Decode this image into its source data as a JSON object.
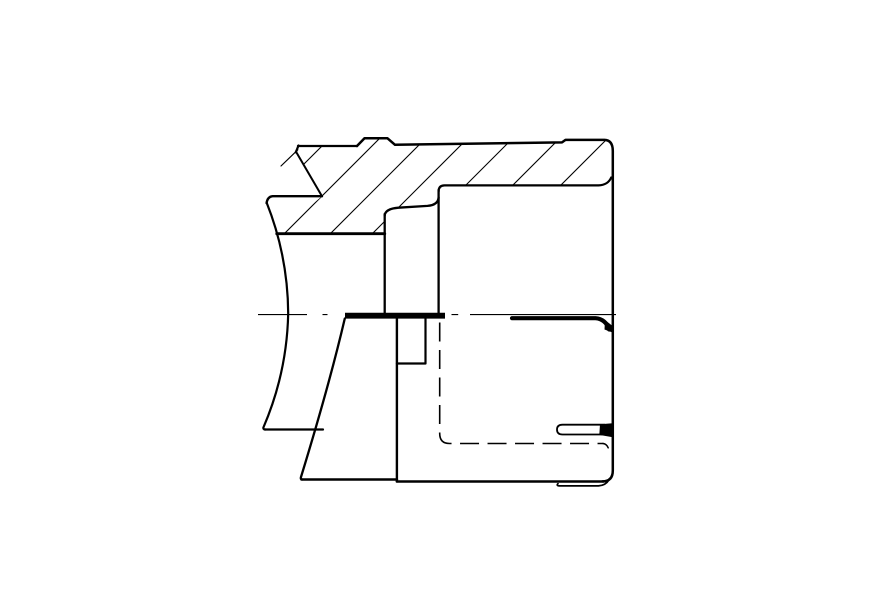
{
  "drawing": {
    "description": "engineering-section-view",
    "background": "#ffffff",
    "ink": "#000000",
    "viewport": {
      "width": 891,
      "height": 603
    },
    "hatch": {
      "clip_d": "M298,146 L357,146 L364.5,138.3 L387.5,138.3 L395,144.8 L562,142.4 L565.5,139.9 L609,140 L612.8,152 L612.8,184.8 L444,184.8 L438.6,191.5 L438.6,197.5 L427.5,205.9 L398.5,207.7 L384.7,215.5 L384.7,233.7 L276.8,233.7 L322,196.2 L295.9,151.5 Z",
      "c_values": [
        468,
        518,
        564,
        606,
        651,
        698,
        746
      ],
      "y_min": 128,
      "y_max": 242,
      "w": 1.1
    },
    "strokes": [
      {
        "name": "outline-top-left-edge",
        "d": "M298,146 H357",
        "w": 2.3
      },
      {
        "name": "outline-bump-and-right-wall",
        "d": "M357,146 L364.5,138.3 H387.5 L395,144.8 L562,142.4 L565.5,139.9 H604.5 Q612.8,140.2 612.8,151 V470.5 Q612.8,481.4 602.5,481.4",
        "w": 2.5
      },
      {
        "name": "cavity-top-edge",
        "d": "M438.6,191.5 Q438.6,185.4 444.5,185.4 H598.5 Q608,185 611.2,177.5",
        "w": 2.2
      },
      {
        "name": "inner-wall-vertical",
        "d": "M438.6,190 V313.2",
        "w": 2.3
      },
      {
        "name": "step-profile",
        "d": "M438.6,197.5 Q438,205 427.5,205.9 L398.5,207.7 Q385.2,208.8 384.7,215.5",
        "w": 2.3
      },
      {
        "name": "hatch-left-wall",
        "d": "M384.7,214 V313.2",
        "w": 2.3
      },
      {
        "name": "hatch-bottom-edge",
        "d": "M276.8,233.7 H384.7",
        "w": 2.9
      },
      {
        "name": "break-tick",
        "d": "M298.5,145.5 L295.8,152.3",
        "w": 2.2
      },
      {
        "name": "break-line-steep",
        "d": "M295.9,151.5 L322,196.2",
        "w": 2.0
      },
      {
        "name": "break-jag-thin",
        "d": "M297.8,149.8 L281,166",
        "w": 1.2
      },
      {
        "name": "left-part-top-edge",
        "d": "M322,196.2 H272.6 Q267.6,196.6 266.6,203",
        "w": 2.4
      },
      {
        "name": "left-spherical-arc",
        "d": "M266.6,202.5 A305,305 0 0 1 288.2,313.5 A305,305 0 0 1 263.4,427.5 Q263,429.5 265.5,429.5",
        "w": 2.2
      },
      {
        "name": "left-part-bottom-edge",
        "d": "M264.5,429.5 H323",
        "w": 2.2
      },
      {
        "name": "sleeve-arc",
        "d": "M344.8,318.5 Q329.5,384 301,477 Q300.2,479.5 302.5,479.5",
        "w": 2.3
      },
      {
        "name": "sleeve-bottom-edge",
        "d": "M301.5,479.5 H396.9",
        "w": 2.5
      },
      {
        "name": "body-bottom-edge",
        "d": "M396.9,481.5 H603.5",
        "w": 2.5
      },
      {
        "name": "sleeve-right-wall",
        "d": "M396.9,318.5 V481.5",
        "w": 2.4
      },
      {
        "name": "key-notch",
        "d": "M425.5,318.5 V363.5 H396.9",
        "w": 2.2
      },
      {
        "name": "seal-lip",
        "d": "M512,318.2 H595.5 Q605.5,319 609.2,329.5",
        "w": 4.2
      },
      {
        "name": "slot-outline",
        "d": "M604.5,424.7 H562.5 Q557,424.8 557,429.5 Q557,434.5 562.5,434.5 H603",
        "w": 1.8
      },
      {
        "name": "bottom-undercut",
        "d": "M558,483.6 Q555.6,485.9 560.5,485.9 H598.5 Q605.8,485.3 609,479.8",
        "w": 1.7
      },
      {
        "name": "hidden-line-end-hook",
        "d": "M603,443.5 Q606.5,443.8 608.2,447.8",
        "w": 1.5
      }
    ],
    "dashed": [
      {
        "name": "hidden-bore-line",
        "d": "M439.7,322.5 V433.5 Q439.7,443.5 449.5,443.5 H603.5",
        "w": 1.6,
        "dash": "19 8.5"
      },
      {
        "name": "centerline",
        "d": "M258,314.6 H307 M322.5,314.6 H327.5 M451.5,314.6 H458.2 M470,314.6 H616",
        "w": 1.15,
        "dash": ""
      }
    ],
    "fills": [
      {
        "name": "contact-bar",
        "d": "M345,312.8 H445 V318.6 H345 Z"
      },
      {
        "name": "slot-wedge",
        "d": "M600,424.3 L612.6,423.2 L612.8,437.2 L599.3,434.9 Z"
      },
      {
        "name": "lip-tip-wedge",
        "d": "M605,320 L612.6,326 L612.6,332.5 L604.5,329.5 Z"
      }
    ]
  }
}
